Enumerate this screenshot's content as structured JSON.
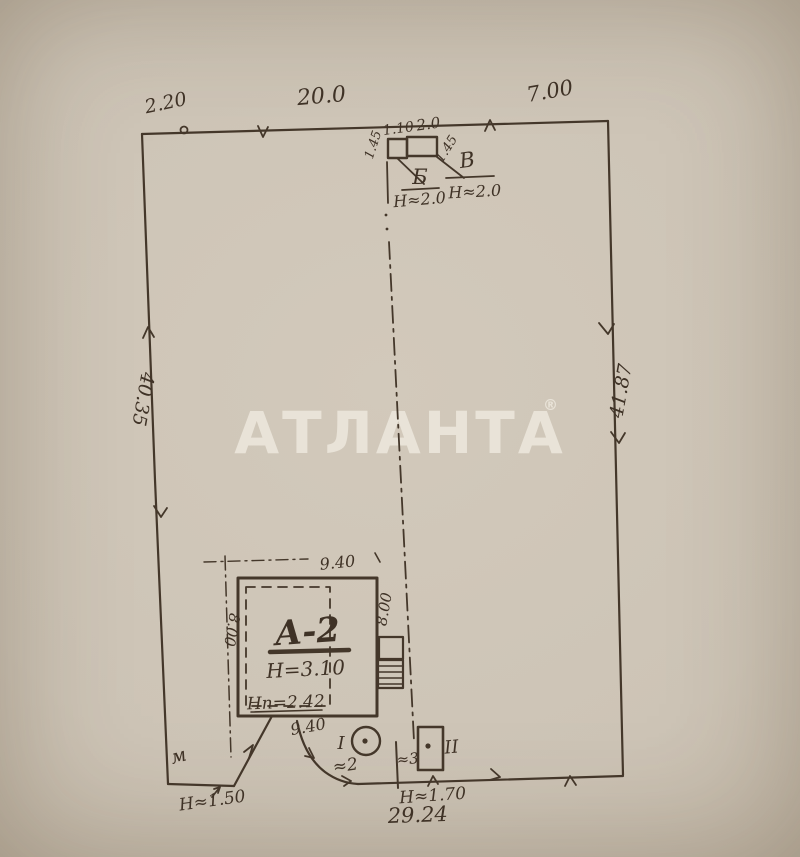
{
  "watermark": {
    "text": "АТЛАНТА",
    "reg": "®"
  },
  "boundary": {
    "top_left": "2.20",
    "top_mid": "20.0",
    "top_right": "7.00",
    "left_side": "40.35",
    "right_side": "41.87",
    "bottom_total": "29.24"
  },
  "outbuildings": {
    "b_label": "Б",
    "b_height": "Н≈2.0",
    "b_width": "1.10",
    "b_depth": "1.45",
    "v_label": "В",
    "v_height": "Н≈2.0",
    "v_width": "2.0",
    "v_depth": "1.45"
  },
  "house": {
    "label": "А-2",
    "height": "Н=3.10",
    "note": "Нп=2.42",
    "dim_top": "9.40",
    "dim_bottom": "9.40",
    "dim_left": "8.00",
    "dim_right": "8.00"
  },
  "yard": {
    "well_label": "I",
    "shed_label": "II",
    "gate_label": "≈2",
    "wicket_label": "≈3",
    "fence_height_right": "Н≈1.70",
    "fence_height_left": "Н≈1.50",
    "corner_mark": "м"
  }
}
